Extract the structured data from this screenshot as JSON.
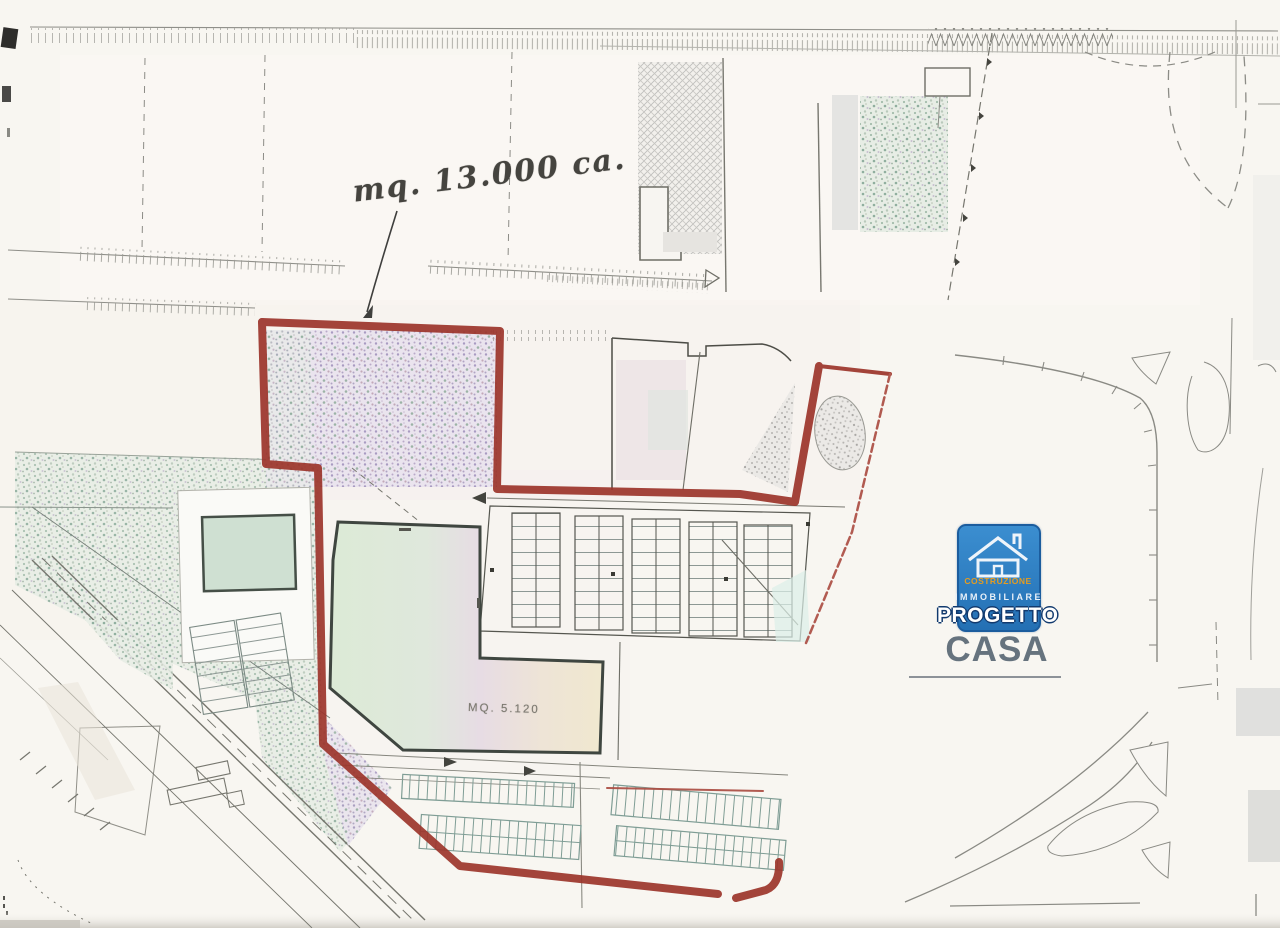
{
  "document": {
    "kind": "scanned site plan (planimetria) with highlighted lot boundary"
  },
  "annotations": {
    "site_area_note": "mq. 13.000 ca.",
    "building_area_label": "MQ. 5.120"
  },
  "logo": {
    "line1": "COSTRUZIONE",
    "line2": "IMMOBILIARE",
    "line3": "PROGETTO",
    "line4": "CASA",
    "colors": {
      "box_blue": "#2e7fc2",
      "line1_orange": "#e59c20",
      "line3_white": "#ffffff",
      "casa_grey_blue": "#66737e"
    }
  },
  "plan": {
    "boundary_color_red": "#9c352b",
    "boundary_color_red_thin": "#ab4d43",
    "speckle_purple": "#c3b7cf",
    "speckle_green": "#c6d6ca",
    "building_fill_left_green": "#dcead6",
    "building_fill_mid_pink": "#e7dae2",
    "building_fill_right_yellow": "#efe7cd",
    "parking_stroke_teal": "#7f9d95",
    "paper": "#f8f6f1"
  }
}
